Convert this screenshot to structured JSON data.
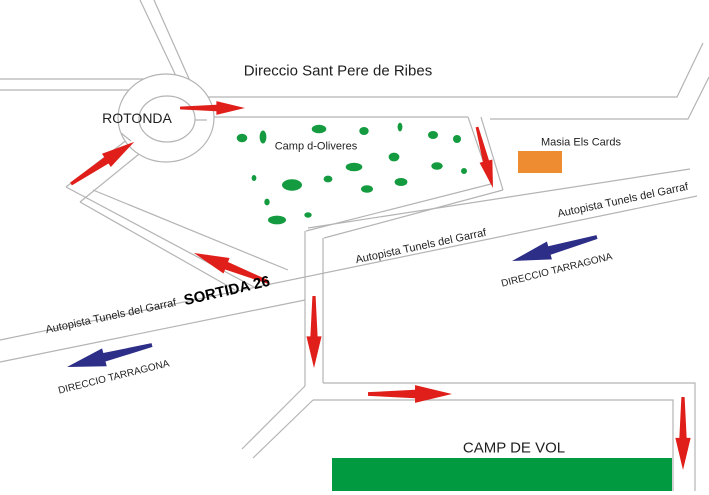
{
  "labels": {
    "direction_ribes": "Direccio Sant Pere de Ribes",
    "rotonda": "ROTONDA",
    "olive_field": "Camp d-Oliveres",
    "masia": "Masia Els Cards",
    "autopista": "Autopista Tunels del Garraf",
    "sortida": "SORTIDA 26",
    "tarragona": "DIRECCIO TARRAGONA",
    "camp_de_vol": "CAMP DE VOL"
  },
  "colors": {
    "route_arrow": "#e01f1a",
    "tarragona_arrow": "#2d2e87",
    "olive_tree": "#149b3f",
    "camp_field": "#029a40",
    "masia_building": "#ee8c31",
    "road_line": "#b4b4b4",
    "text": "#1f1f1f"
  }
}
